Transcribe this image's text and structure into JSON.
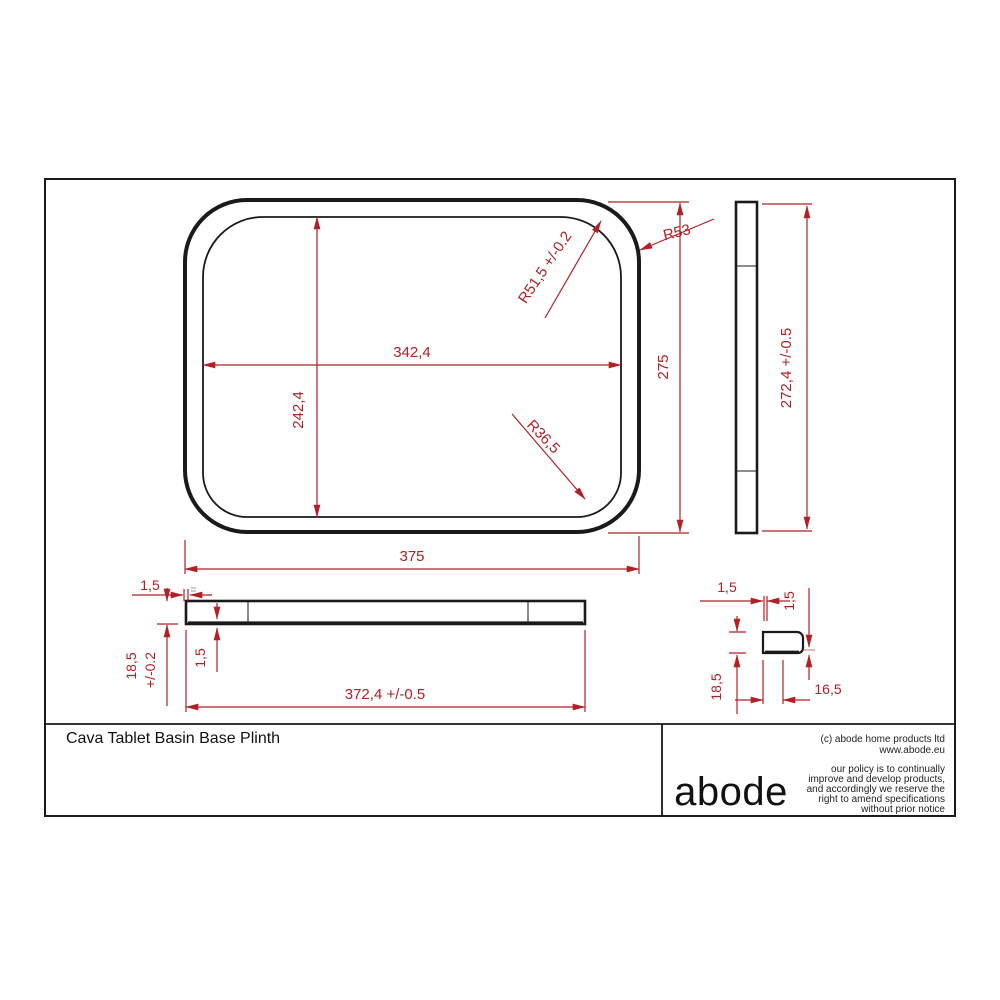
{
  "drawing": {
    "type": "technical-drawing",
    "units_note": "millimetres",
    "plan_view": {
      "outer_width": "375",
      "outer_height": "275",
      "inner_width": "342,4",
      "inner_height": "242,4",
      "outer_corner_radius": "R53",
      "inner_corner_radius_top": "R51,5 +/-0.2",
      "inner_corner_radius_bottom": "R36,5"
    },
    "side_view": {
      "height": "272,4 +/-0.5"
    },
    "front_view": {
      "edge_wall": "1,5",
      "thickness": "18,5",
      "thickness_tol": "+/-0.2",
      "base_wall": "1,5",
      "width": "372,4 +/-0.5"
    },
    "profile_view": {
      "wall_top": "1,5",
      "wall_right": "1,5",
      "height": "18,5",
      "width": "16,5"
    },
    "title_block": {
      "title": "Cava Tablet Basin Base Plinth",
      "logo": "abode",
      "copyright": "(c) abode home products ltd",
      "website": "www.abode.eu",
      "policy_lines": [
        "our policy is to continually",
        "improve and develop products,",
        "and accordingly we reserve the",
        "right to amend specifications",
        "without prior notice"
      ]
    },
    "colors": {
      "dimension_red": "#b02025",
      "line_black": "#1a1a1a"
    }
  }
}
